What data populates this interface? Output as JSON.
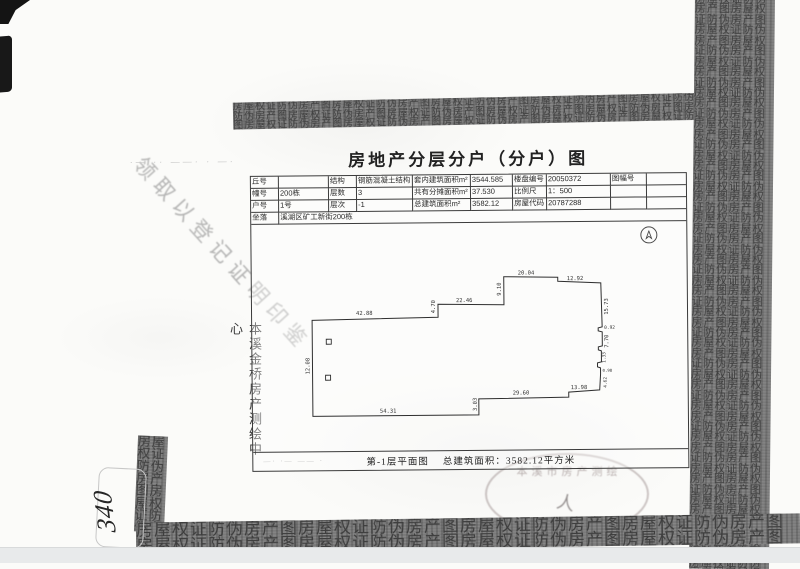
{
  "page": {
    "title": "房地产分层分户（分户）图",
    "caption_left": "第-1层平面图",
    "caption_right": "总建筑面积：3582.12平方米",
    "surveyor_vertical": "本溪金桥房产测绘中心",
    "diagonal_note": "领取以登记证明印鉴",
    "handwritten_number": "340",
    "title_scribble": "·— ·· ——· · —·",
    "caption_scribble": "—· ·— —— ·"
  },
  "table": {
    "rows": [
      [
        "丘号",
        "",
        "结构",
        "钢筋混凝土结构",
        "套内建筑面积m²",
        "3544.585",
        "楼盘编号",
        "20050372",
        "图幅号",
        ""
      ],
      [
        "幢号",
        "200栋",
        "层数",
        "3",
        "共有分摊面积m²",
        "37.530",
        "比例尺",
        "1：500",
        "",
        ""
      ],
      [
        "户号",
        "1号",
        "层次",
        "-1",
        "总建筑面积m²",
        "3582.12",
        "房屋代码",
        "20787288",
        "",
        ""
      ]
    ],
    "site_label": "坐落",
    "site_value": "溪湖区矿工新街200栋"
  },
  "plan": {
    "dims": [
      "42.88",
      "4.70",
      "22.46",
      "9.10",
      "20.04",
      "12.92",
      "15.73",
      "0.92",
      "7.70",
      "1.33",
      "0.98",
      "4.62",
      "13.98",
      "29.60",
      "3.03",
      "54.31",
      "12.08"
    ]
  },
  "seal": {
    "arc_text": "本溪市房产测绘",
    "center_mark": "人"
  },
  "texture": {
    "pattern_text": "房屋权证防伪房产图"
  },
  "colors": {
    "ink": "#2b2b2b",
    "band_gray": "#7a7a7a",
    "paper": "#fbfbf9"
  }
}
